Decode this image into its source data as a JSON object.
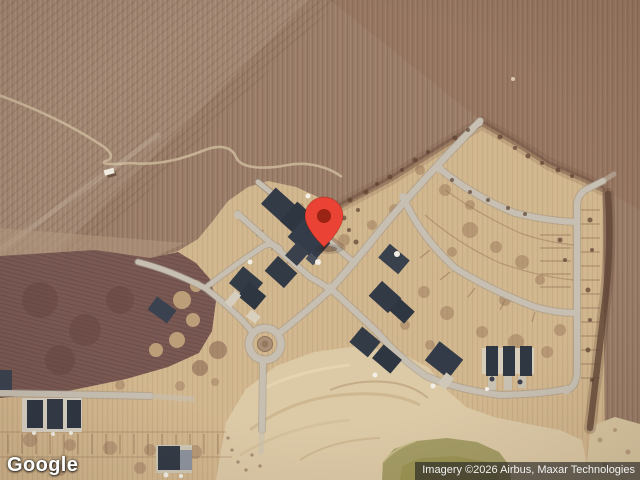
{
  "page": {
    "width": 640,
    "height": 480
  },
  "map": {
    "description": "Satellite view of a housing development under construction surrounded by plowed farmland, with a red location marker, roundabout and retention pond",
    "marker": {
      "color": "#EA4335",
      "inner_color": "#9A2313",
      "tip_x": 324,
      "tip_y": 247
    },
    "palette": {
      "field_brown": "#9B7E69",
      "field_dark_mauve": "#7A5953",
      "development_tan": "#D2B78E",
      "sand": "#DCC9A6",
      "pond_olive": "#A49C65",
      "road_gray": "#C6BFB2",
      "roof_dark": "#333B47"
    }
  },
  "branding": {
    "logo_text": "Google"
  },
  "attribution": {
    "text": "Imagery ©2026 Airbus, Maxar Technologies"
  }
}
